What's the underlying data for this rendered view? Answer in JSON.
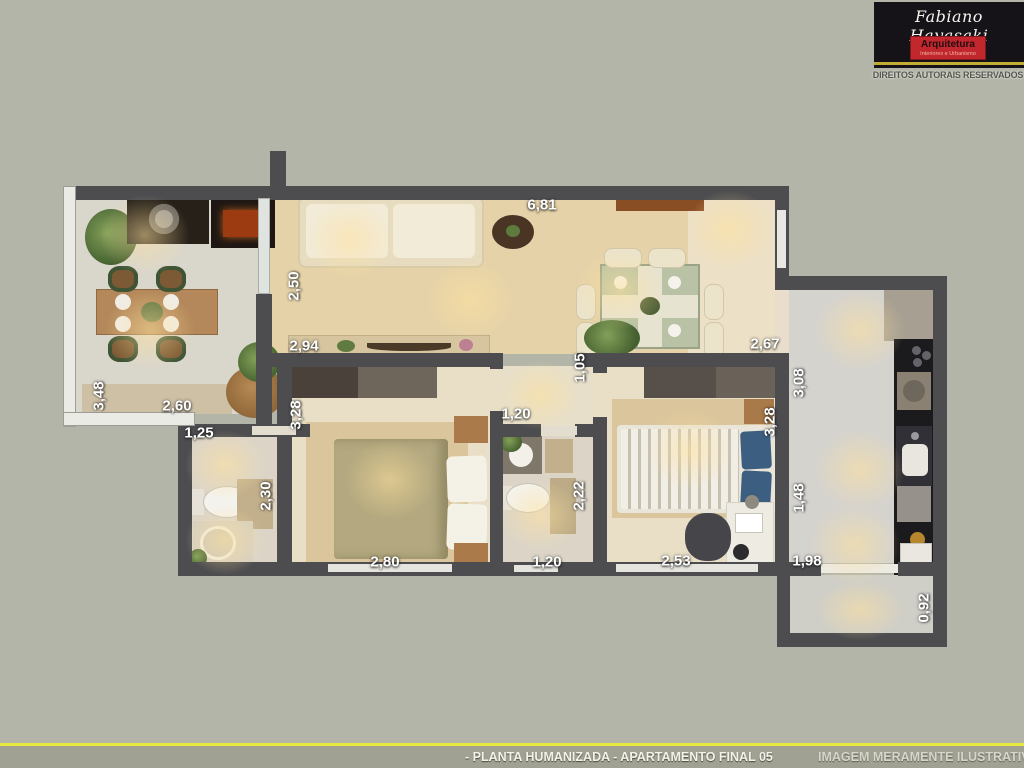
{
  "brand": {
    "name": "Fabiano Hayasaki",
    "field": "Arquitetura",
    "tagline": "Interiores e Urbanismo",
    "rights": "DIREITOS AUTORAIS RESERVADOS"
  },
  "footer": {
    "title": "- PLANTA HUMANIZADA - APARTAMENTO FINAL 05",
    "disclaimer": "IMAGEM MERAMENTE ILUSTRATIVA"
  },
  "colors": {
    "background": "#b3b5a8",
    "wall_dark": "#4d4d50",
    "wall_light": "#ebebe6",
    "floor_living": "#e5d2a8",
    "floor_bedroom": "#e9dfc7",
    "floor_tile": "#d5d3ce",
    "rug": "#dbc59c",
    "accent_yellow": "#e6e93e",
    "logo_red": "#c1272d",
    "logo_black": "#151218",
    "dimension_text": "#ffffff"
  },
  "dimensions": [
    "6,81",
    "2,50",
    "2,94",
    "2,67",
    "1,05",
    "3,08",
    "3,48",
    "2,60",
    "1,25",
    "3,28",
    "2,30",
    "1,20",
    "2,22",
    "3,28",
    "1,48",
    "2,80",
    "1,20",
    "2,53",
    "1,98",
    "0,92"
  ]
}
